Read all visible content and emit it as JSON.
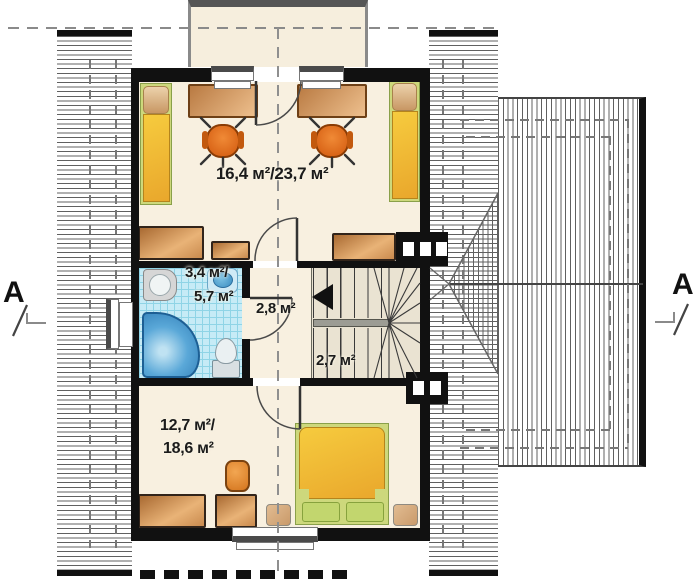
{
  "rooms": {
    "study": {
      "label": "16,4 м²/23,7 м²"
    },
    "bathroom": {
      "label_line1": "3,4 м²/",
      "label_line2": "5,7 м²"
    },
    "hall": {
      "label": "2,8 м²"
    },
    "staircase": {
      "label": "2,7 м²"
    },
    "bedroom": {
      "label_line1": "12,7 м²/",
      "label_line2": "18,6 м²"
    }
  },
  "section_markers": {
    "left": "A",
    "right": "A"
  },
  "colors": {
    "wall": "#111111",
    "floor": "#f8f0e0",
    "hatch": "#606060",
    "tile": "#c6ebf6",
    "chair": "#e8741e",
    "bed_yellow": "#f2c235",
    "bed_green": "#c2d66e",
    "tub": "#4a9fd4"
  }
}
